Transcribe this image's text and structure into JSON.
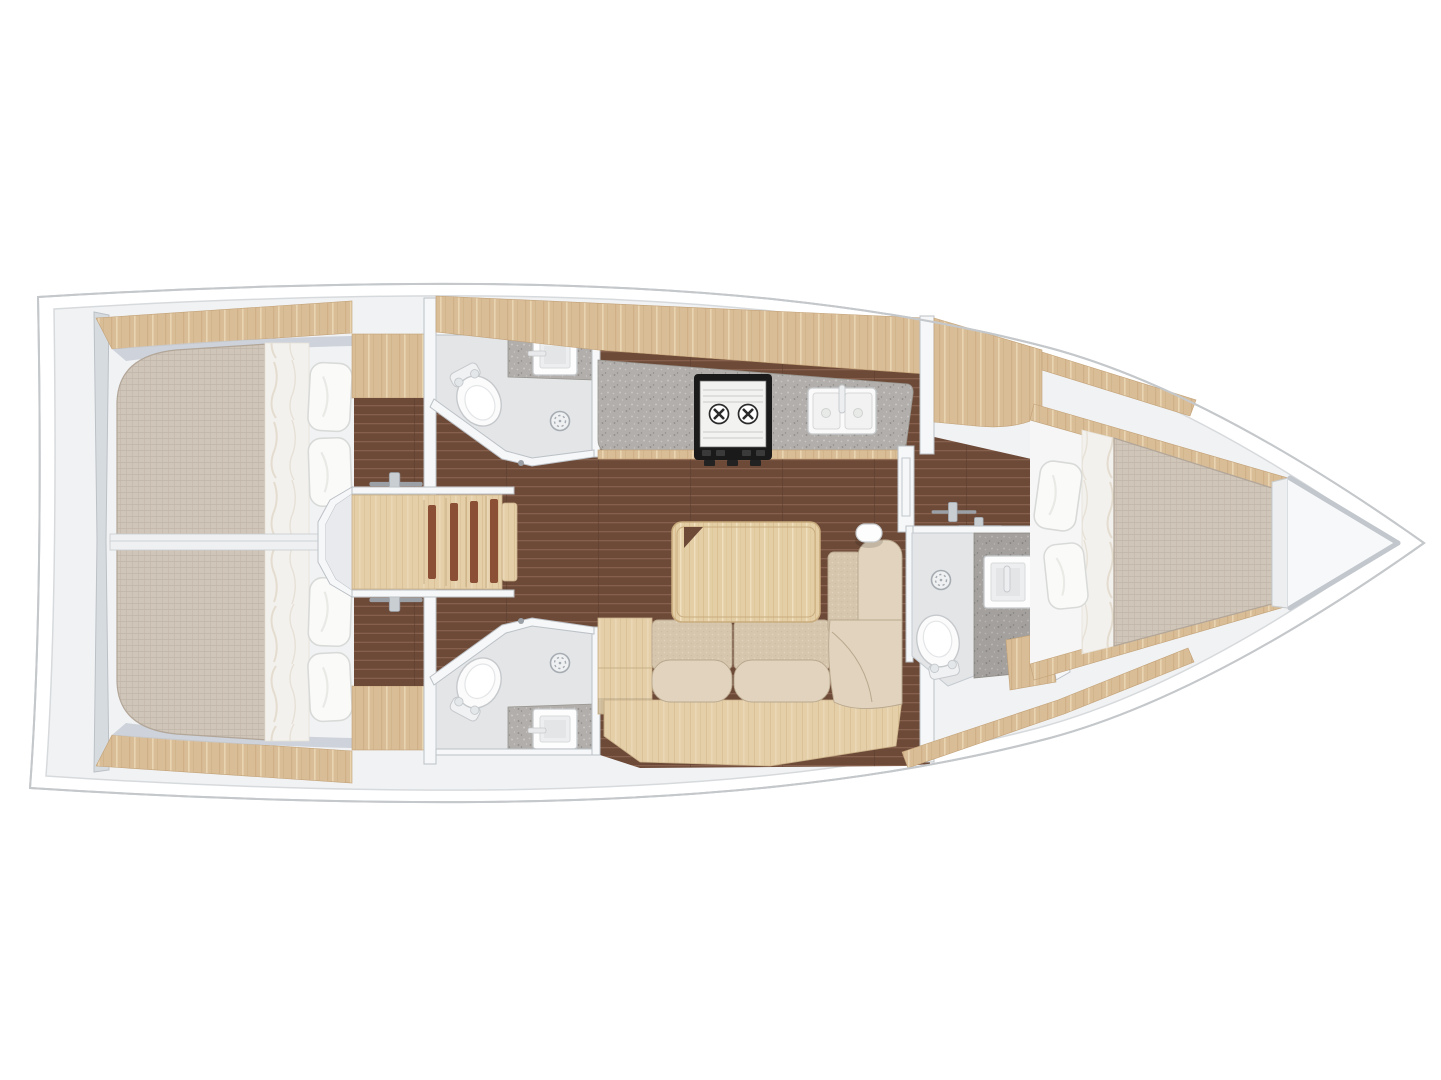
{
  "meta": {
    "title": "Sailing yacht interior layout — top-down floor plan, bow to the right (3 cabins, 3 heads, saloon and galley)",
    "image_type": "rendered yacht floor plan",
    "orientation": {
      "bow": "right",
      "stern": "left"
    },
    "canvas": {
      "width": 1441,
      "height": 1080
    }
  },
  "colors": {
    "hull_fill": "#ffffff",
    "hull_stroke": "#c5c8cb",
    "deck_line": "#d7dadc",
    "interior_bg": "#f1f2f4",
    "wall_fill": "#f6f7f8",
    "wall_stroke": "#bcc1c6",
    "transom_fill": "#d6dbe0",
    "wood": "#d9bd97",
    "wood_grain_dark": "#c8a678",
    "wood_grain_light": "#ecd9b6",
    "wood_pale": "#e4cfa9",
    "stair_inlay": "#8a4f35",
    "floor": "#6d4a38",
    "floor_line": "#8b6450",
    "floor_seam": "#5a3c2d",
    "mattress": "#cfc5b9",
    "mattress_line": "#c1b6a9",
    "mattress_stroke": "#b2a698",
    "sheet": "#f3f1ee",
    "sheet_streak": "#e2dacc",
    "pillow": "#fafaf9",
    "pillow_stroke": "#d8dad8",
    "sofa": "#d6c6ae",
    "sofa_light": "#e1d3bd",
    "sofa_seam": "#b9a88f",
    "table": "#e4cea6",
    "table_stroke": "#c9ac7d",
    "counter": "#b1aeab",
    "counter_dot_dark": "#8e8b88",
    "counter_dot_light": "#c9c6c3",
    "fixture": "#fbfbfb",
    "fixture_stroke": "#c6c9cc",
    "steel": "#9aa0a6",
    "drain_ring": "#a6acb2",
    "bath_floor": "#e3e5e7",
    "bath_floor_dark": "#d4d7da",
    "stove_frame": "#1a1a1a",
    "stove_top": "#f2f2f0",
    "burner": "#2b2b2b",
    "locker": "#f7f8f9",
    "bow_wall": "#c2c7cd"
  },
  "rooms": {
    "aft_cabin_port": {
      "label": "Aft double cabin (port)"
    },
    "aft_cabin_starboard": {
      "label": "Aft double cabin (starboard)"
    },
    "companionway": {
      "label": "Companionway steps"
    },
    "head_aft_port": {
      "label": "Aft head with shower (port)"
    },
    "head_aft_starboard": {
      "label": "Aft head with shower (starboard)"
    },
    "galley": {
      "label": "Galley"
    },
    "salon": {
      "label": "Saloon"
    },
    "corridor": {
      "label": "Passage to forward cabin"
    },
    "head_forward": {
      "label": "Forward head with shower"
    },
    "forward_cabin": {
      "label": "Forward V-berth cabin"
    },
    "bow_locker": {
      "label": "Bow anchor locker"
    }
  },
  "fixtures": {
    "double_berth": "Double berth with two pillows",
    "v_berth": "V-berth with two pillows",
    "settee": "L-shaped settee",
    "saloon_table": "Saloon table",
    "stove": "Two-burner stove",
    "galley_sink": "Double galley sink with faucet",
    "wash_basin": "Square wash basin",
    "toilet": "Marine toilet",
    "shower_drain": "Shower drain",
    "steps": "Companionway steps with inlays",
    "door_handle": "Door handle",
    "mast_post": "Mast post"
  }
}
